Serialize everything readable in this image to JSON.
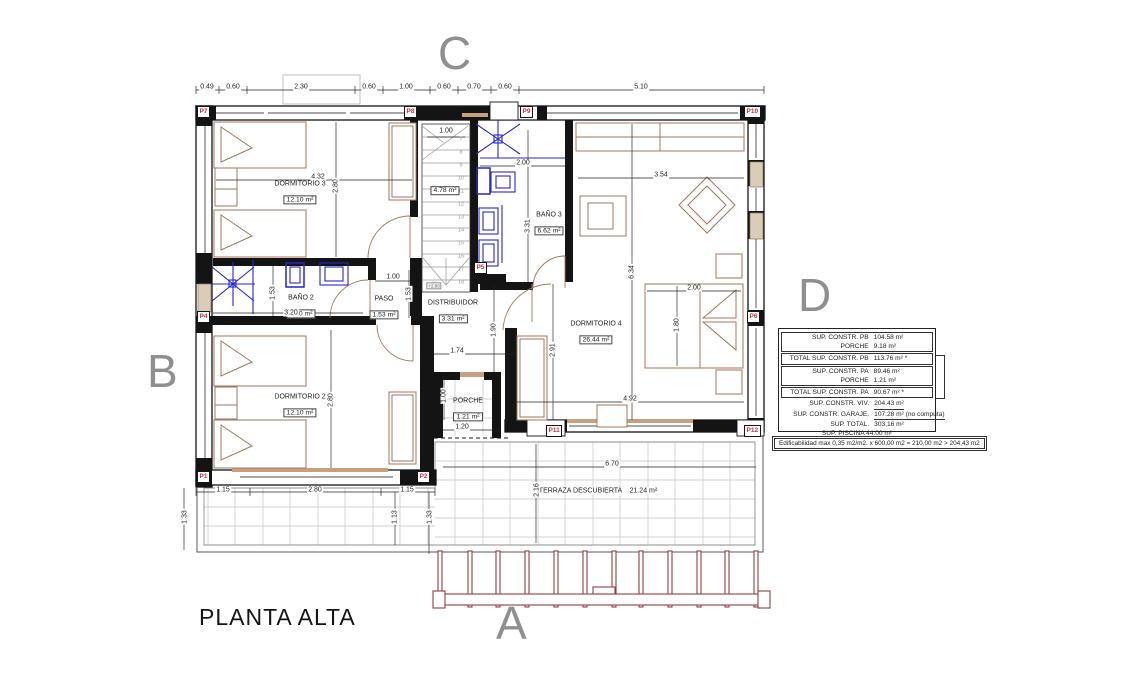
{
  "title": "PLANTA ALTA",
  "colors": {
    "wall": "#141414",
    "furniture": "#a3765c",
    "fixtures_blue": "#2626cc",
    "marker_red": "#c23232",
    "letter_gray": "#8f8f8f",
    "grid_gray": "#bdbdbd",
    "pergola_red": "#8f4040"
  },
  "letters": [
    {
      "t": "C",
      "x": 438,
      "y": 30
    },
    {
      "t": "B",
      "x": 147,
      "y": 348
    },
    {
      "t": "D",
      "x": 798,
      "y": 272
    },
    {
      "t": "A",
      "x": 496,
      "y": 600
    }
  ],
  "rooms": [
    {
      "name": "DORMITORIO 3",
      "area": "12.10 m²",
      "x": 300,
      "y": 193
    },
    {
      "name": "BAÑO 2",
      "area": "4.90 m²",
      "x": 301,
      "y": 307
    },
    {
      "name": "PASO",
      "area": "1.53 m²",
      "x": 384,
      "y": 308
    },
    {
      "name": "DISTRIBUIDOR",
      "area": "3.31 m²",
      "x": 453,
      "y": 312
    },
    {
      "name": "BAÑO 3",
      "area": "6.62 m²",
      "x": 549,
      "y": 224
    },
    {
      "name": "DORMITORIO 4",
      "area": "26.44 m²",
      "x": 596,
      "y": 333
    },
    {
      "name": "DORMITORIO 2",
      "area": "12.10 m²",
      "x": 300,
      "y": 406
    },
    {
      "name": "PORCHE",
      "area": "1.21 m²",
      "x": 468,
      "y": 410
    },
    {
      "name": "",
      "area": "4.78 m²",
      "x": 445,
      "y": 188
    }
  ],
  "terrace_label": "TERRAZA DESCUBIERTA    21.24 m²",
  "dims": [
    {
      "t": "0.49",
      "x": 207,
      "y": 87
    },
    {
      "t": "0.60",
      "x": 233,
      "y": 87
    },
    {
      "t": "2.30",
      "x": 301,
      "y": 87
    },
    {
      "t": "0.60",
      "x": 369,
      "y": 87
    },
    {
      "t": "1.00",
      "x": 406,
      "y": 87
    },
    {
      "t": "0.60",
      "x": 444,
      "y": 87
    },
    {
      "t": "0.70",
      "x": 474,
      "y": 87
    },
    {
      "t": "0.60",
      "x": 505,
      "y": 87
    },
    {
      "t": "5.10",
      "x": 641,
      "y": 87
    },
    {
      "t": "4.32",
      "x": 318,
      "y": 177
    },
    {
      "t": "2.80",
      "x": 336,
      "y": 186,
      "r": -90
    },
    {
      "t": "1.00",
      "x": 446,
      "y": 131
    },
    {
      "t": "2.00",
      "x": 523,
      "y": 163
    },
    {
      "t": "3.31",
      "x": 528,
      "y": 226,
      "r": -90
    },
    {
      "t": "3.54",
      "x": 661,
      "y": 175
    },
    {
      "t": "6.34",
      "x": 632,
      "y": 272,
      "r": -90
    },
    {
      "t": "2.00",
      "x": 694,
      "y": 288
    },
    {
      "t": "1.80",
      "x": 677,
      "y": 325,
      "r": -90
    },
    {
      "t": "4.92",
      "x": 630,
      "y": 399
    },
    {
      "t": "2.91",
      "x": 553,
      "y": 350,
      "r": -90
    },
    {
      "t": "1.90",
      "x": 494,
      "y": 330,
      "r": -90
    },
    {
      "t": "1.74",
      "x": 457,
      "y": 351
    },
    {
      "t": "1.53",
      "x": 273,
      "y": 293,
      "r": -90
    },
    {
      "t": "3.20",
      "x": 291,
      "y": 313
    },
    {
      "t": "1.00",
      "x": 393,
      "y": 277
    },
    {
      "t": "1.53",
      "x": 409,
      "y": 294,
      "r": -90
    },
    {
      "t": "2.80",
      "x": 331,
      "y": 400,
      "r": -90
    },
    {
      "t": "1.00",
      "x": 444,
      "y": 396,
      "r": -90
    },
    {
      "t": "1.20",
      "x": 462,
      "y": 427
    },
    {
      "t": "1.15",
      "x": 223,
      "y": 490
    },
    {
      "t": "2.80",
      "x": 315,
      "y": 490
    },
    {
      "t": "1.15",
      "x": 407,
      "y": 490
    },
    {
      "t": "1.33",
      "x": 185,
      "y": 517,
      "r": -90
    },
    {
      "t": "1.13",
      "x": 395,
      "y": 517,
      "r": -90
    },
    {
      "t": "1.33",
      "x": 430,
      "y": 517,
      "r": -90
    },
    {
      "t": "6.70",
      "x": 612,
      "y": 464
    },
    {
      "t": "2.16",
      "x": 537,
      "y": 490,
      "r": -90
    }
  ],
  "markers": [
    {
      "t": "P1",
      "x": 197,
      "y": 471
    },
    {
      "t": "P2",
      "x": 417,
      "y": 471
    },
    {
      "t": "P4",
      "x": 197,
      "y": 311
    },
    {
      "t": "P5",
      "x": 474,
      "y": 262
    },
    {
      "t": "P6",
      "x": 747,
      "y": 311
    },
    {
      "t": "P7",
      "x": 197,
      "y": 106
    },
    {
      "t": "P8",
      "x": 404,
      "y": 106
    },
    {
      "t": "P9",
      "x": 520,
      "y": 106
    },
    {
      "t": "P10",
      "x": 744,
      "y": 106
    },
    {
      "t": "P11",
      "x": 546,
      "y": 425
    },
    {
      "t": "P12",
      "x": 744,
      "y": 425
    }
  ],
  "stairs": {
    "steps": [
      {
        "t": "7",
        "x": 461,
        "y": 140
      },
      {
        "t": "8",
        "x": 461,
        "y": 153
      },
      {
        "t": "9",
        "x": 461,
        "y": 166
      },
      {
        "t": "10",
        "x": 461,
        "y": 179
      },
      {
        "t": "11",
        "x": 461,
        "y": 192
      },
      {
        "t": "12",
        "x": 461,
        "y": 205
      },
      {
        "t": "13",
        "x": 461,
        "y": 218
      },
      {
        "t": "14",
        "x": 461,
        "y": 231
      },
      {
        "t": "15",
        "x": 461,
        "y": 244
      },
      {
        "t": "16",
        "x": 461,
        "y": 257
      },
      {
        "t": "17",
        "x": 461,
        "y": 270
      },
      {
        "t": "18",
        "x": 461,
        "y": 283
      }
    ],
    "tags": [
      {
        "t": "+2.80",
        "x": 434,
        "y": 286
      }
    ]
  },
  "summary": {
    "rows": [
      {
        "label": "SUP. CONSTR. PB",
        "value": "104.58 m²"
      },
      {
        "label": "PORCHE",
        "value": "9.18 m²"
      },
      {
        "label": "TOTAL SUP. CONSTR. PB",
        "value": "113.76 m² *"
      },
      {
        "label": "SUP. CONSTR. PA",
        "value": "89.46 m²"
      },
      {
        "label": "PORCHE",
        "value": "1.21 m²"
      },
      {
        "label": "TOTAL SUP. CONSTR. PA",
        "value": "90.67 m² *"
      },
      {
        "label": "SUP. CONSTR. VIV.",
        "value": "204.43 m²"
      },
      {
        "label": "SUP. CONSTR. GARAJE.",
        "value": "107.28 m² (no computa)"
      },
      {
        "label": "SUP. TOTAL.",
        "value": "303,16 m²"
      }
    ],
    "piscina": "SUP. PISCINA 44.00 m²",
    "edificabilidad": "Edificabilidad max  0,35 m2/m2. x 600,00 m2 = 210,00 m2 > 204,43 m2"
  }
}
